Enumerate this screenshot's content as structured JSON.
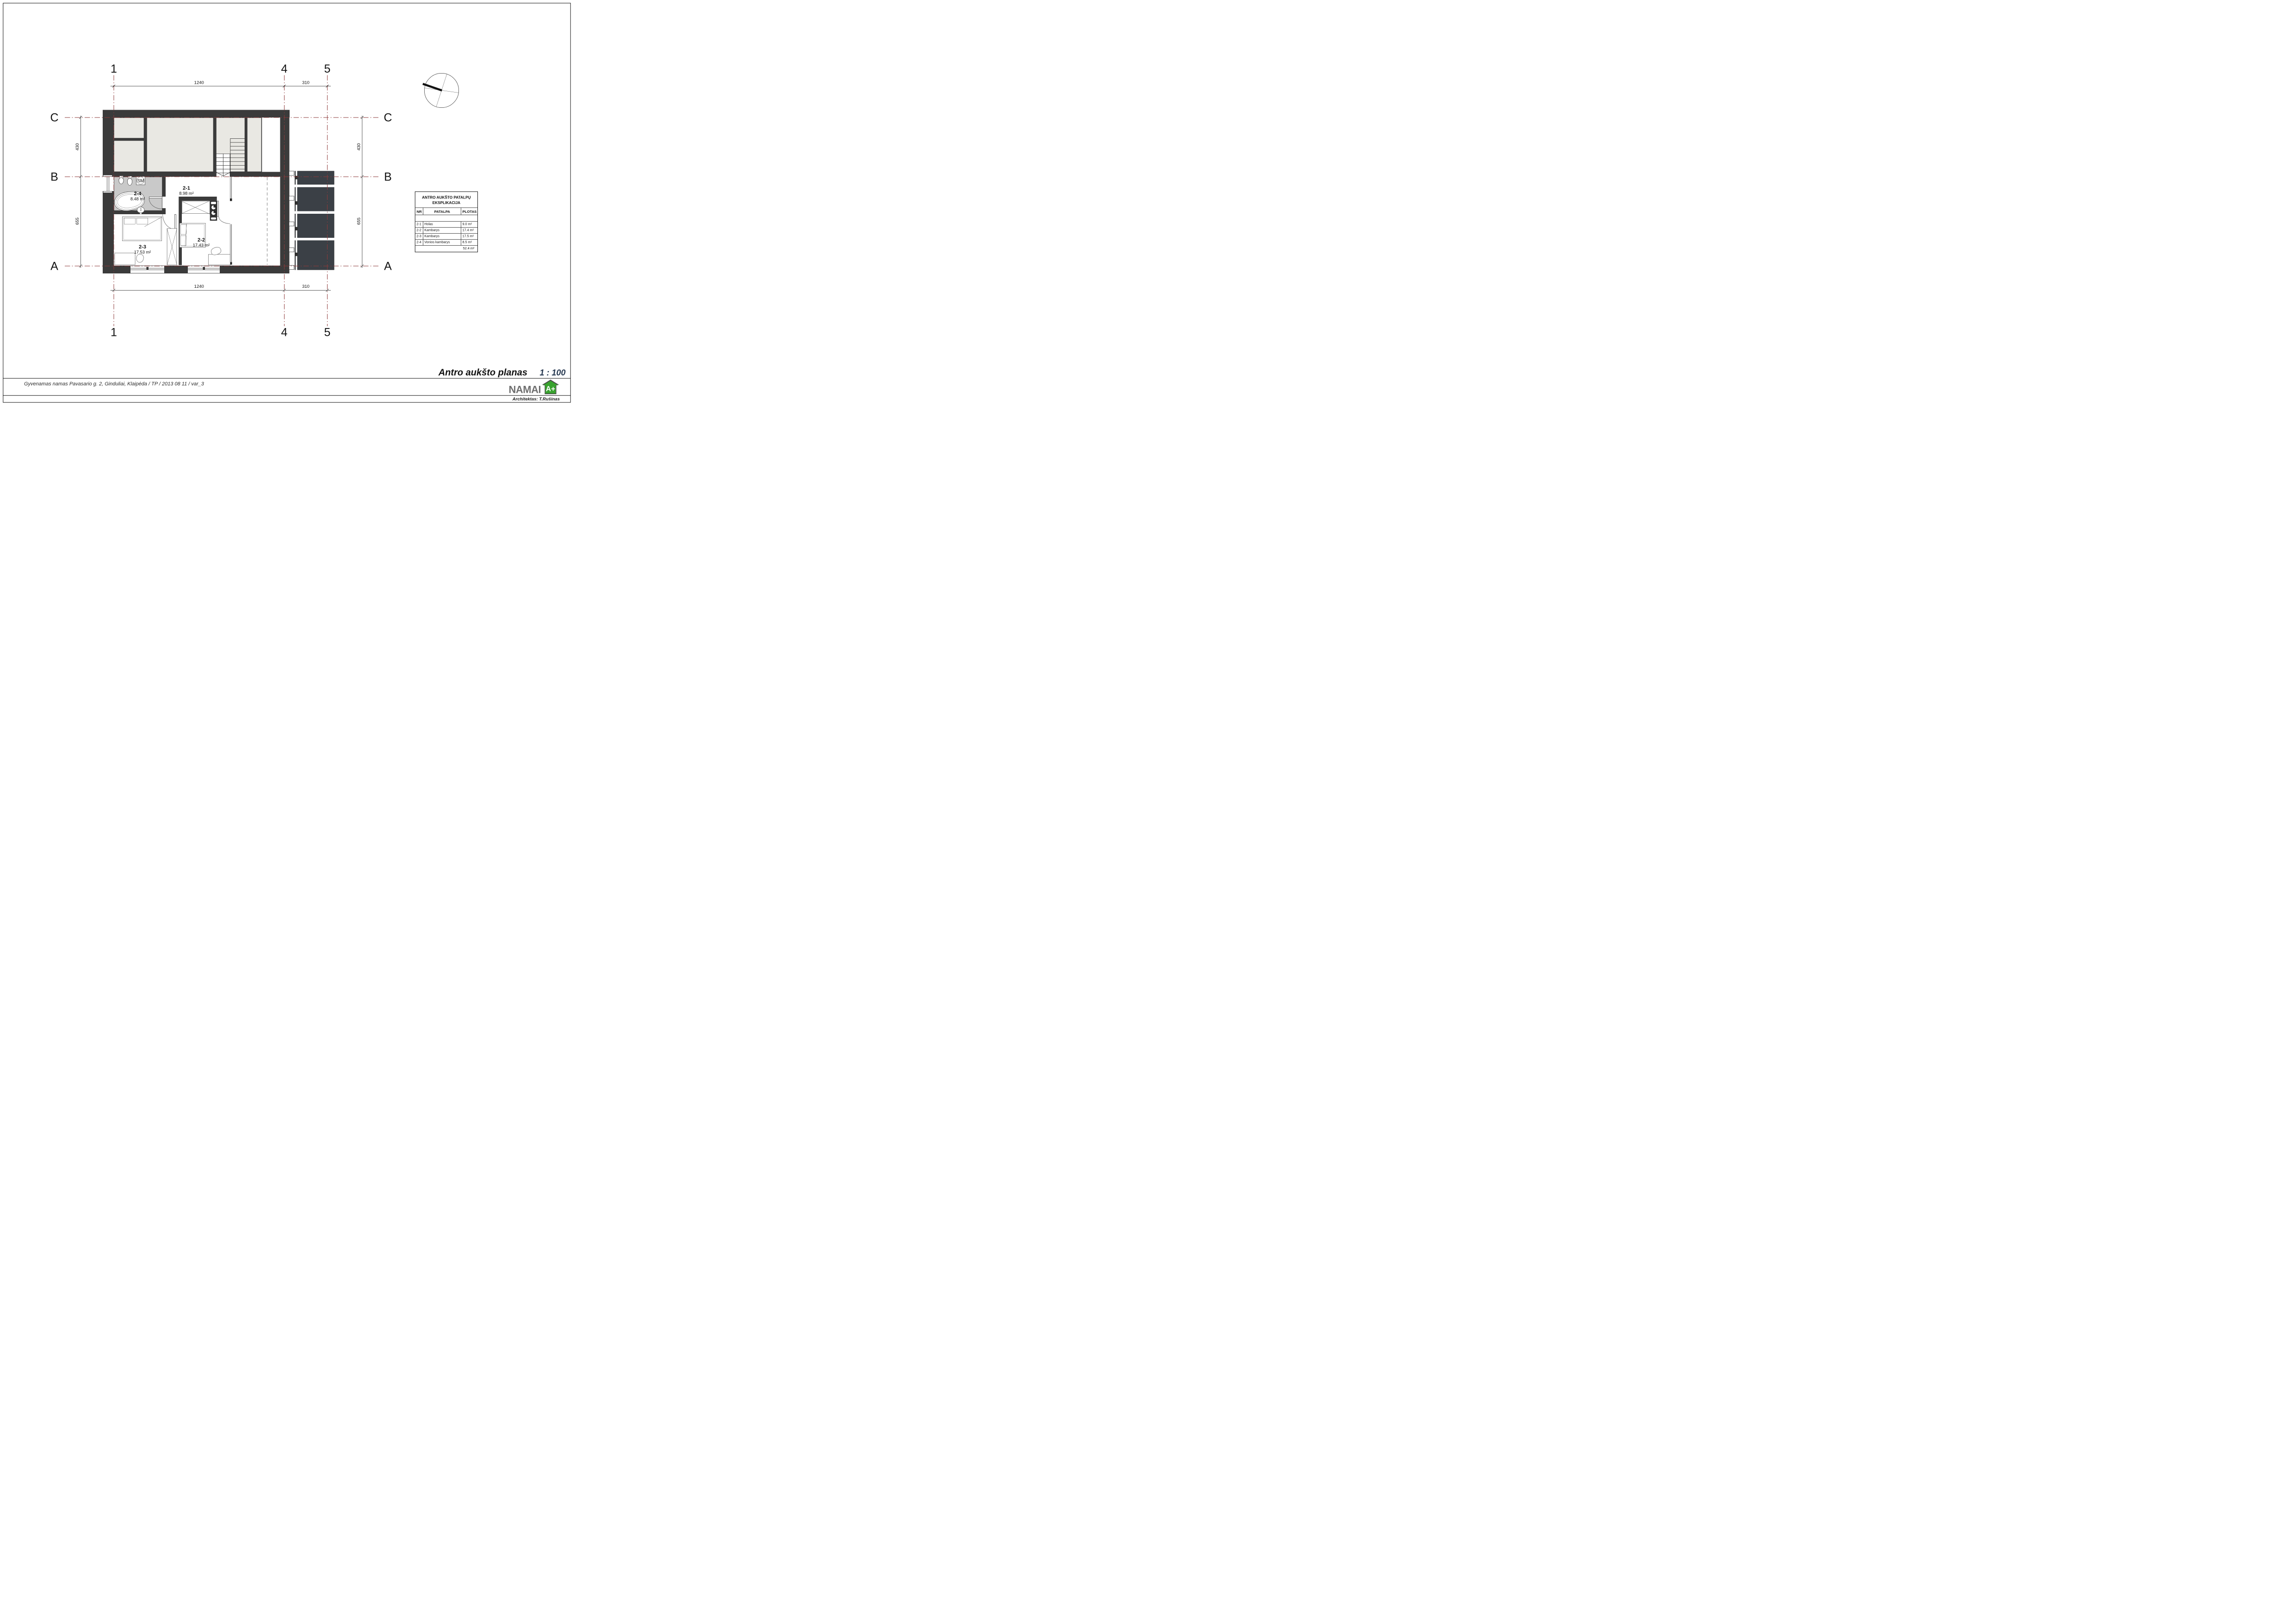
{
  "drawing": {
    "title": "Antro aukšto planas",
    "scale_label": "1 : 100"
  },
  "footer": {
    "project": "Gyvenamas namas Pavasario g. 2, Ginduliai, Klaipėda / TP / 2013 08 11 / var_3",
    "architect": "Architektas: T.Rušinas",
    "brand": "NAMAI",
    "energy_badge": "A+"
  },
  "grid": {
    "columns": [
      "1",
      "4",
      "5"
    ],
    "rows": [
      "C",
      "B",
      "A"
    ]
  },
  "dimensions": {
    "top": [
      "1240",
      "310"
    ],
    "bottom": [
      "1240",
      "310"
    ],
    "left": [
      "430",
      "655"
    ],
    "right": [
      "430",
      "655"
    ]
  },
  "rooms": [
    {
      "id": "2-1",
      "area": "8.98 m²"
    },
    {
      "id": "2-2",
      "area": "17.43 m²"
    },
    {
      "id": "2-3",
      "area": "17.53 m²"
    },
    {
      "id": "2-4",
      "area": "8.48 m²"
    }
  ],
  "labels": {
    "washing_machine": "SM"
  },
  "explication_table": {
    "title_line1": "ANTRO AUKŠTO PATALPŲ",
    "title_line2": "EKSPLIKACIJA",
    "headers": [
      "NR",
      "PATALPA",
      "PLOTAS"
    ],
    "rows": [
      [
        "2-1",
        "Holas",
        "9.0 m²"
      ],
      [
        "2-2",
        "Kambarys",
        "17.4 m²"
      ],
      [
        "2-3",
        "Kambarys",
        "17.5 m²"
      ],
      [
        "2-4",
        "Vonios kambarys",
        "8.5 m²"
      ]
    ],
    "total": "52.4 m²"
  },
  "colors": {
    "wall": "#3b3b3b",
    "attic_floor": "#e9e8e3",
    "bath_floor": "#c9c9c9",
    "terrace": "#3b4046",
    "grid_line": "#8e3a3a",
    "scale_text": "#263850",
    "brand_gray": "#6f6f6f",
    "brand_green": "#38a32e"
  }
}
